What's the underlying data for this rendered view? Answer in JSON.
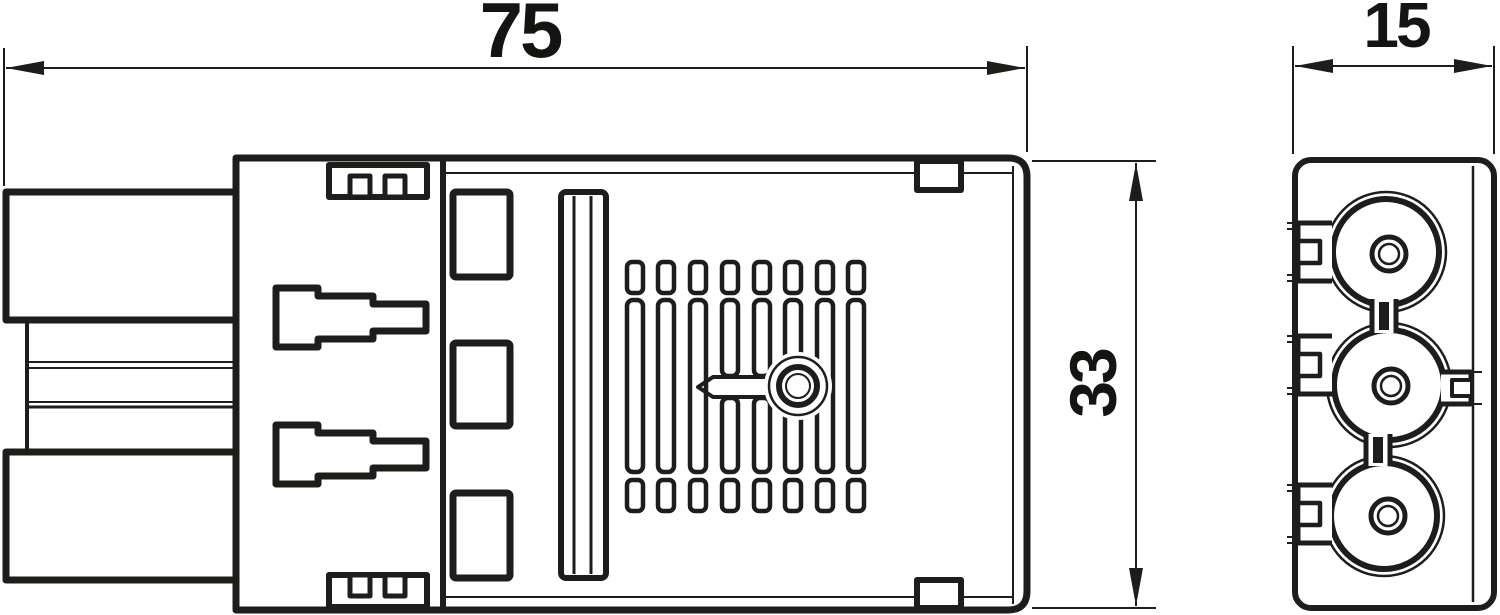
{
  "drawing": {
    "type": "technical-dimension-drawing",
    "colors": {
      "background": "#ffffff",
      "line": "#1d1d1b",
      "text": "#141412"
    },
    "dimensions": {
      "length": {
        "value": "75"
      },
      "width": {
        "value": "15"
      },
      "height": {
        "value": "33"
      }
    }
  }
}
